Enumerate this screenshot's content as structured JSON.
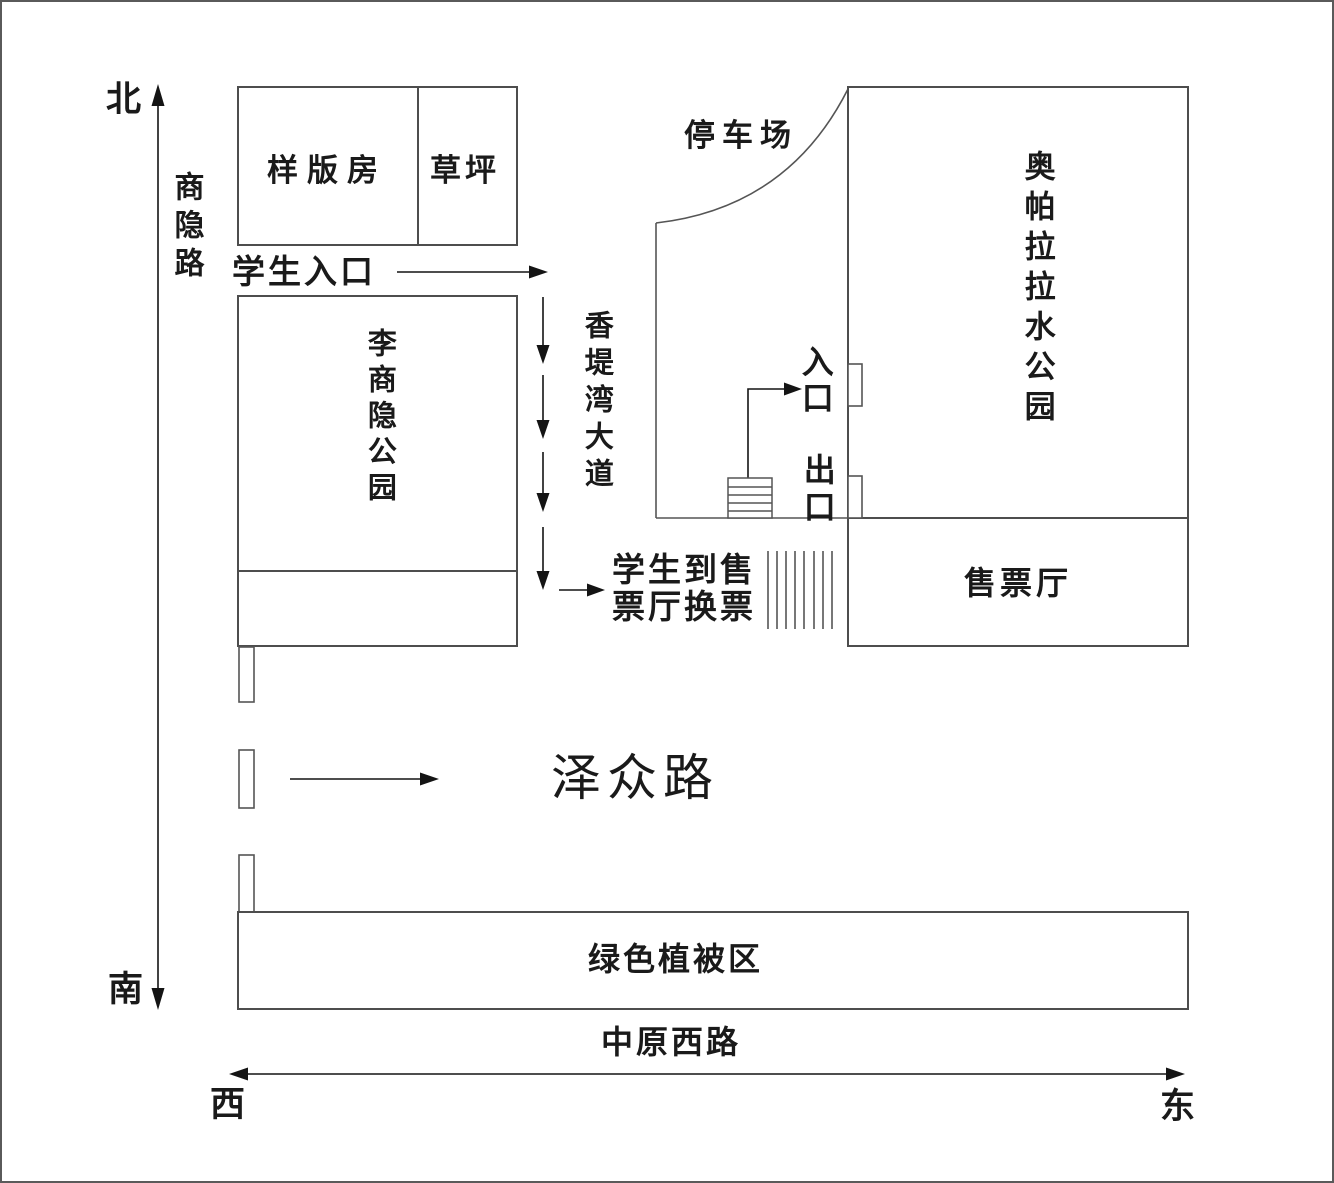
{
  "page": {
    "background": "#ffffff",
    "border_color": "#5a5a5a",
    "box_stroke_color": "#4d4d4d",
    "arrow_color": "#141414",
    "hatch_color": "#777777"
  },
  "compass": {
    "north": "北",
    "south": "南",
    "west": "西",
    "east": "东"
  },
  "roads": {
    "shangyin_road": "商隐路",
    "xiangtiwan_avenue": "香堤湾大道",
    "zezhong_road": "泽众路",
    "zhongyuan_west_road": "中原西路"
  },
  "places": {
    "model_room": "样版房",
    "lawn": "草坪",
    "student_entrance": "学生入口",
    "li_shangyin_park": "李商隐公园",
    "parking_lot": "停车场",
    "water_park": "奥帕拉拉水公园",
    "entrance": "入口",
    "exit": "出口",
    "ticket_note": "学生到售票厅换票",
    "ticket_hall": "售票厅",
    "green_area": "绿色植被区"
  }
}
